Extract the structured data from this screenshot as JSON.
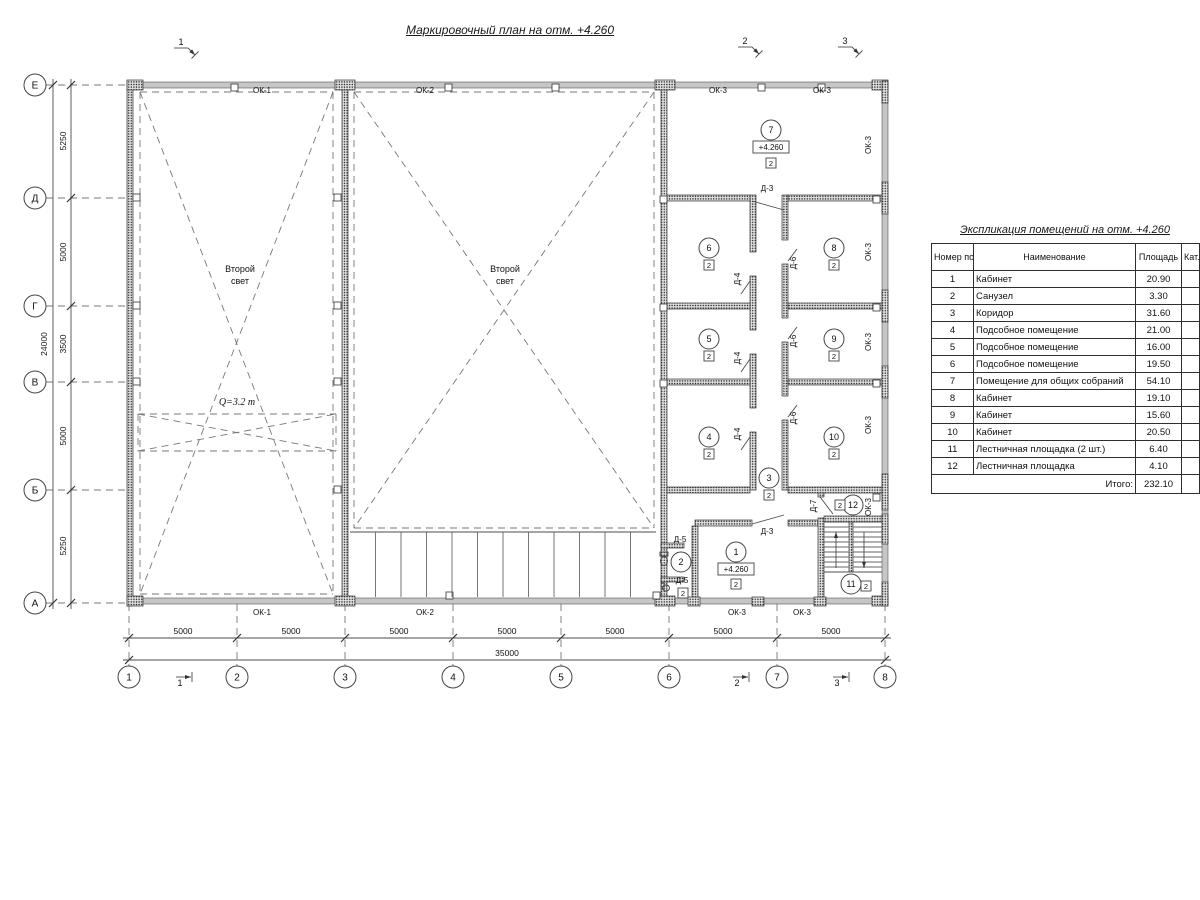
{
  "page": {
    "title": "Маркировочный план на отм. +4.260"
  },
  "schedule": {
    "title": "Экспликация помещений на отм. +4.260",
    "headers": {
      "num": "Номер помещ.",
      "name": "Наименование",
      "area": "Площадь",
      "cat": "Кат. пом."
    },
    "rows": [
      [
        "1",
        "Кабинет",
        "20.90"
      ],
      [
        "2",
        "Санузел",
        "3.30"
      ],
      [
        "3",
        "Коридор",
        "31.60"
      ],
      [
        "4",
        "Подсобное помещение",
        "21.00"
      ],
      [
        "5",
        "Подсобное помещение",
        "16.00"
      ],
      [
        "6",
        "Подсобное помещение",
        "19.50"
      ],
      [
        "7",
        "Помещение для общих собраний",
        "54.10"
      ],
      [
        "8",
        "Кабинет",
        "19.10"
      ],
      [
        "9",
        "Кабинет",
        "15.60"
      ],
      [
        "10",
        "Кабинет",
        "20.50"
      ],
      [
        "11",
        "Лестничная площадка (2 шт.)",
        "6.40"
      ],
      [
        "12",
        "Лестничная площадка",
        "4.10"
      ]
    ],
    "total_label": "Итого:",
    "total": "232.10"
  },
  "plan": {
    "grid_rows": [
      {
        "label": "Е",
        "y": 85
      },
      {
        "label": "Д",
        "y": 198
      },
      {
        "label": "Г",
        "y": 306
      },
      {
        "label": "В",
        "y": 382
      },
      {
        "label": "Б",
        "y": 490
      },
      {
        "label": "А",
        "y": 603
      }
    ],
    "grid_cols": [
      {
        "label": "1",
        "x": 129
      },
      {
        "label": "2",
        "x": 237
      },
      {
        "label": "3",
        "x": 345
      },
      {
        "label": "4",
        "x": 453
      },
      {
        "label": "5",
        "x": 561
      },
      {
        "label": "6",
        "x": 669
      },
      {
        "label": "7",
        "x": 777
      },
      {
        "label": "8",
        "x": 885
      }
    ],
    "dims_left": [
      {
        "t": "5250",
        "y": 141
      },
      {
        "t": "5000",
        "y": 252
      },
      {
        "t": "3500",
        "y": 344
      },
      {
        "t": "5000",
        "y": 436
      },
      {
        "t": "5250",
        "y": 546
      }
    ],
    "dim_left_total": {
      "t": "24000",
      "x": 47,
      "y": 344
    },
    "dims_bottom": [
      {
        "t": "5000",
        "x": 183
      },
      {
        "t": "5000",
        "x": 291
      },
      {
        "t": "5000",
        "x": 399
      },
      {
        "t": "5000",
        "x": 507
      },
      {
        "t": "5000",
        "x": 615
      },
      {
        "t": "5000",
        "x": 723
      },
      {
        "t": "5000",
        "x": 831
      }
    ],
    "dim_bottom_total": {
      "t": "35000",
      "x": 507,
      "y": 656
    },
    "sections_top": [
      {
        "label": "1",
        "x": 181,
        "y": 45
      },
      {
        "label": "2",
        "x": 745,
        "y": 44
      },
      {
        "label": "3",
        "x": 845,
        "y": 44
      }
    ],
    "sections_bottom": [
      {
        "label": "1",
        "x": 180,
        "y": 686
      },
      {
        "label": "2",
        "x": 737,
        "y": 686
      },
      {
        "label": "3",
        "x": 837,
        "y": 686
      }
    ],
    "texts": [
      {
        "t": "Второй",
        "x": 240,
        "y": 272
      },
      {
        "t": "свет",
        "x": 240,
        "y": 284
      },
      {
        "t": "Второй",
        "x": 505,
        "y": 272
      },
      {
        "t": "свет",
        "x": 505,
        "y": 284
      },
      {
        "t": "Q=3.2 т",
        "x": 237,
        "y": 405,
        "cls": "serif"
      }
    ],
    "window_labels": [
      {
        "t": "ОК-1",
        "x": 262,
        "y": 93
      },
      {
        "t": "ОК-2",
        "x": 425,
        "y": 93
      },
      {
        "t": "ОК-3",
        "x": 718,
        "y": 93
      },
      {
        "t": "ОК-3",
        "x": 822,
        "y": 93
      },
      {
        "t": "ОК-1",
        "x": 262,
        "y": 615
      },
      {
        "t": "ОК-2",
        "x": 425,
        "y": 615
      },
      {
        "t": "ОК-3",
        "x": 737,
        "y": 615
      },
      {
        "t": "ОК-3",
        "x": 802,
        "y": 615
      },
      {
        "t": "ОК-3",
        "x": 871,
        "y": 145,
        "rot": 1
      },
      {
        "t": "ОК-3",
        "x": 871,
        "y": 252,
        "rot": 1
      },
      {
        "t": "ОК-3",
        "x": 871,
        "y": 342,
        "rot": 1
      },
      {
        "t": "ОК-3",
        "x": 871,
        "y": 425,
        "rot": 1
      },
      {
        "t": "ОК-3",
        "x": 871,
        "y": 507,
        "rot": 1
      }
    ],
    "door_labels": [
      {
        "t": "Д-3",
        "x": 767,
        "y": 191
      },
      {
        "t": "Д-3",
        "x": 767,
        "y": 534
      },
      {
        "t": "Д-4",
        "x": 740,
        "y": 279,
        "rot": 1
      },
      {
        "t": "Д-4",
        "x": 740,
        "y": 358,
        "rot": 1
      },
      {
        "t": "Д-4",
        "x": 740,
        "y": 434,
        "rot": 1
      },
      {
        "t": "Д-6",
        "x": 796,
        "y": 263,
        "rot": 1
      },
      {
        "t": "Д-6",
        "x": 796,
        "y": 341,
        "rot": 1
      },
      {
        "t": "Д-6",
        "x": 796,
        "y": 418,
        "rot": 1
      },
      {
        "t": "Д-5",
        "x": 680,
        "y": 542
      },
      {
        "t": "Д-5",
        "x": 682,
        "y": 583
      },
      {
        "t": "Д-7",
        "x": 816,
        "y": 506,
        "rot": 1
      }
    ],
    "room_markers": [
      {
        "n": "7",
        "x": 771,
        "y": 130,
        "bx": 771,
        "by": 163,
        "b": "2"
      },
      {
        "n": "6",
        "x": 709,
        "y": 248,
        "bx": 709,
        "by": 265,
        "b": "2"
      },
      {
        "n": "8",
        "x": 834,
        "y": 248,
        "bx": 834,
        "by": 265,
        "b": "2"
      },
      {
        "n": "5",
        "x": 709,
        "y": 339,
        "bx": 709,
        "by": 356,
        "b": "2"
      },
      {
        "n": "9",
        "x": 834,
        "y": 339,
        "bx": 834,
        "by": 356,
        "b": "2"
      },
      {
        "n": "4",
        "x": 709,
        "y": 437,
        "bx": 709,
        "by": 454,
        "b": "2"
      },
      {
        "n": "10",
        "x": 834,
        "y": 437,
        "bx": 834,
        "by": 454,
        "b": "2"
      },
      {
        "n": "3",
        "x": 769,
        "y": 478,
        "bx": 769,
        "by": 495,
        "b": "2"
      },
      {
        "n": "1",
        "x": 736,
        "y": 552,
        "bx": 736,
        "by": 584,
        "b": "2"
      },
      {
        "n": "2",
        "x": 681,
        "y": 562,
        "bx": 683,
        "by": 593,
        "b": "2"
      },
      {
        "n": "11",
        "x": 851,
        "y": 584,
        "bx": 866,
        "by": 586,
        "b": "2"
      },
      {
        "n": "12",
        "x": 853,
        "y": 505,
        "bx": 840,
        "by": 505,
        "b": "2"
      }
    ],
    "levels": [
      {
        "t": "+4.260",
        "x": 771,
        "y": 147
      },
      {
        "t": "+4.260",
        "x": 736,
        "y": 569
      }
    ],
    "walls_window": [
      [
        133,
        82,
        741,
        6
      ],
      [
        133,
        598,
        741,
        6
      ],
      [
        882,
        82,
        6,
        522
      ]
    ],
    "walls_hatch": [
      [
        127,
        81,
        6,
        525
      ],
      [
        342,
        88,
        6,
        511
      ],
      [
        661,
        88,
        6,
        511
      ],
      [
        750,
        195,
        6,
        57
      ],
      [
        750,
        276,
        6,
        54
      ],
      [
        750,
        354,
        6,
        54
      ],
      [
        750,
        432,
        6,
        58
      ],
      [
        782,
        195,
        6,
        45
      ],
      [
        782,
        264,
        6,
        54
      ],
      [
        782,
        342,
        6,
        54
      ],
      [
        782,
        420,
        6,
        70
      ],
      [
        667,
        195,
        83,
        6
      ],
      [
        788,
        195,
        94,
        6
      ],
      [
        667,
        303,
        83,
        6
      ],
      [
        788,
        303,
        94,
        6
      ],
      [
        667,
        379,
        83,
        6
      ],
      [
        788,
        379,
        94,
        6
      ],
      [
        667,
        487,
        83,
        6
      ],
      [
        788,
        487,
        94,
        6
      ],
      [
        695,
        520,
        57,
        6
      ],
      [
        788,
        520,
        30,
        6
      ],
      [
        692,
        526,
        6,
        73
      ],
      [
        661,
        543,
        23,
        5
      ],
      [
        661,
        577,
        23,
        5
      ],
      [
        818,
        493,
        6,
        4
      ],
      [
        818,
        518,
        6,
        81
      ],
      [
        824,
        516,
        58,
        6
      ],
      [
        849,
        522,
        4,
        50
      ],
      [
        127,
        80,
        16,
        10
      ],
      [
        335,
        80,
        20,
        10
      ],
      [
        655,
        80,
        20,
        10
      ],
      [
        872,
        80,
        16,
        10
      ],
      [
        127,
        596,
        16,
        10
      ],
      [
        335,
        596,
        20,
        10
      ],
      [
        655,
        596,
        20,
        10
      ],
      [
        872,
        596,
        16,
        10
      ],
      [
        688,
        597,
        12,
        9
      ],
      [
        752,
        597,
        12,
        9
      ],
      [
        814,
        597,
        12,
        9
      ],
      [
        882,
        81,
        6,
        22
      ],
      [
        882,
        182,
        6,
        32
      ],
      [
        882,
        290,
        6,
        32
      ],
      [
        882,
        366,
        6,
        32
      ],
      [
        882,
        474,
        6,
        36
      ],
      [
        882,
        514,
        6,
        30
      ],
      [
        882,
        582,
        6,
        24
      ]
    ],
    "squares": [
      [
        231,
        84
      ],
      [
        445,
        84
      ],
      [
        552,
        84
      ],
      [
        758,
        84
      ],
      [
        818,
        84
      ],
      [
        446,
        592
      ],
      [
        653,
        592
      ],
      [
        133,
        194
      ],
      [
        133,
        302
      ],
      [
        133,
        378
      ],
      [
        334,
        194
      ],
      [
        334,
        302
      ],
      [
        334,
        378
      ],
      [
        334,
        486
      ],
      [
        660,
        196
      ],
      [
        873,
        196
      ],
      [
        660,
        304
      ],
      [
        873,
        304
      ],
      [
        660,
        380
      ],
      [
        873,
        380
      ],
      [
        873,
        494
      ]
    ],
    "dashed": [
      [
        140,
        92,
        333,
        92
      ],
      [
        333,
        92,
        333,
        594
      ],
      [
        140,
        594,
        333,
        594
      ],
      [
        140,
        92,
        140,
        594
      ],
      [
        140,
        92,
        333,
        594
      ],
      [
        333,
        92,
        140,
        594
      ],
      [
        354,
        92,
        654,
        92
      ],
      [
        654,
        92,
        654,
        528
      ],
      [
        354,
        528,
        654,
        528
      ],
      [
        354,
        92,
        354,
        528
      ],
      [
        354,
        92,
        654,
        528
      ],
      [
        654,
        92,
        354,
        528
      ],
      [
        138,
        414,
        336,
        414
      ],
      [
        336,
        414,
        336,
        451
      ],
      [
        138,
        451,
        336,
        451
      ],
      [
        138,
        414,
        138,
        451
      ],
      [
        138,
        414,
        336,
        451
      ],
      [
        138,
        451,
        336,
        414
      ]
    ],
    "lines": [
      [
        123,
        638,
        891,
        638
      ],
      [
        123,
        660,
        891,
        660
      ],
      [
        71,
        79,
        71,
        609
      ],
      [
        53,
        79,
        53,
        609
      ],
      [
        752,
        201,
        784,
        210
      ],
      [
        752,
        524,
        784,
        515
      ],
      [
        750,
        281,
        741,
        294
      ],
      [
        750,
        359,
        741,
        372
      ],
      [
        750,
        437,
        741,
        450
      ],
      [
        788,
        261,
        797,
        249
      ],
      [
        788,
        339,
        797,
        327
      ],
      [
        788,
        417,
        797,
        405
      ],
      [
        820,
        497,
        833,
        514
      ],
      [
        824,
        522,
        882,
        522
      ],
      [
        824,
        572,
        882,
        572
      ]
    ],
    "arrows": [
      [
        836,
        568,
        836,
        532
      ],
      [
        864,
        532,
        864,
        568
      ]
    ],
    "platform": {
      "x1": 350,
      "x2": 656,
      "ytop": 532,
      "ybot": 597,
      "n": 11
    },
    "stairs": {
      "x1": 824,
      "x2": 882,
      "ytop": 522,
      "ybot": 572,
      "step": 5,
      "gx1": 849,
      "gx2": 853
    },
    "fixtures": {
      "ellipses": [
        [
          664,
          561,
          3.5,
          4.5
        ],
        [
          666,
          588,
          3.5,
          3
        ]
      ],
      "rects": [
        [
          660,
          552,
          8,
          4
        ],
        [
          661,
          583,
          3,
          6
        ]
      ]
    },
    "colors": {
      "line": "#4d4d4d",
      "text": "#111111",
      "window_fill": "#c6c6c6",
      "hatch_dot": "#222222"
    }
  }
}
